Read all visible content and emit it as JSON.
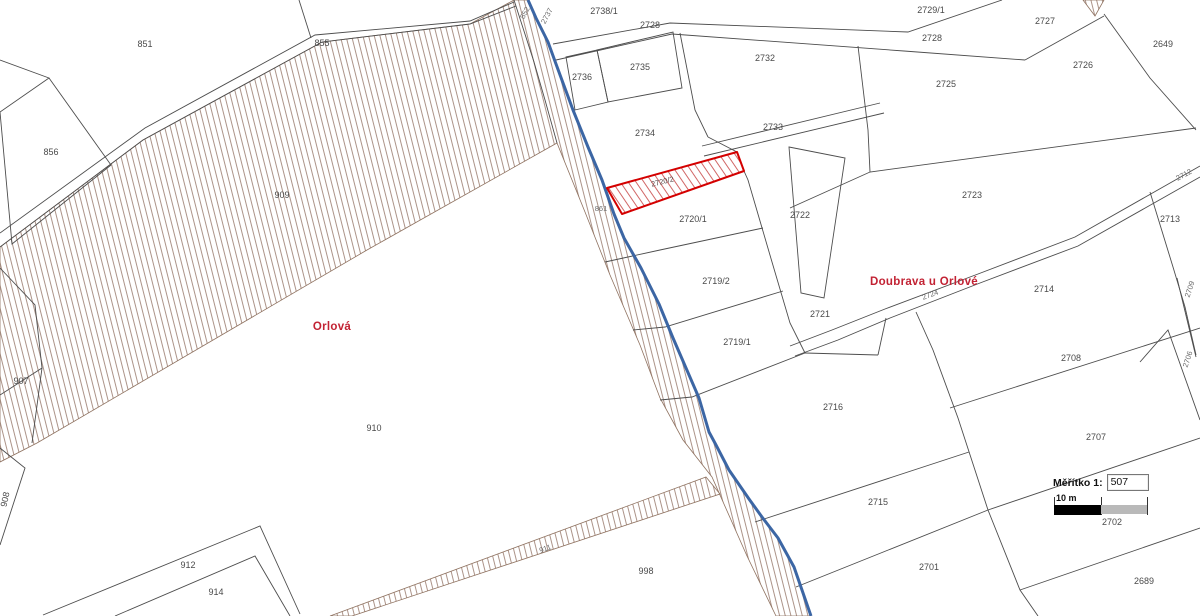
{
  "cities": {
    "left": "Orlová",
    "right": "Doubrava u Orlové"
  },
  "scale": {
    "label": "Měřítko 1:",
    "value": "507",
    "bar_label": "10 m"
  },
  "highlighted_parcel": "2720/2",
  "colors": {
    "boundary_blue": "#3c66a4",
    "parcel_line": "#4d4d4d",
    "hatch_brown": "#8f7260",
    "highlight_red": "#d40000",
    "city_text": "#c22233"
  },
  "parcels": [
    {
      "id": "851",
      "x": 145,
      "y": 47,
      "rot": 0
    },
    {
      "id": "855",
      "x": 322,
      "y": 46,
      "rot": 0
    },
    {
      "id": "856",
      "x": 51,
      "y": 155,
      "rot": 0
    },
    {
      "id": "909",
      "x": 282,
      "y": 198,
      "rot": 0
    },
    {
      "id": "907",
      "x": 21,
      "y": 384,
      "rot": 0
    },
    {
      "id": "908",
      "x": 8,
      "y": 500,
      "rot": -78
    },
    {
      "id": "910",
      "x": 374,
      "y": 431,
      "rot": 0
    },
    {
      "id": "912",
      "x": 188,
      "y": 568,
      "rot": 0
    },
    {
      "id": "914",
      "x": 216,
      "y": 595,
      "rot": 0
    },
    {
      "id": "911",
      "x": 546,
      "y": 551,
      "rot": -20,
      "small": true
    },
    {
      "id": "861",
      "x": 601,
      "y": 211,
      "rot": 0,
      "small": true
    },
    {
      "id": "852",
      "x": 527,
      "y": 14,
      "rot": -62,
      "small": true
    },
    {
      "id": "2737",
      "x": 549,
      "y": 17,
      "rot": -62,
      "small": true
    },
    {
      "id": "2738/1",
      "x": 604,
      "y": 14,
      "rot": 0
    },
    {
      "id": "2728",
      "x": 650,
      "y": 28,
      "rot": 0
    },
    {
      "id": "2736",
      "x": 582,
      "y": 80,
      "rot": 0
    },
    {
      "id": "2735",
      "x": 640,
      "y": 70,
      "rot": 0
    },
    {
      "id": "2734",
      "x": 645,
      "y": 136,
      "rot": 0
    },
    {
      "id": "2732",
      "x": 765,
      "y": 61,
      "rot": 0
    },
    {
      "id": "2733",
      "x": 773,
      "y": 130,
      "rot": 0
    },
    {
      "id": "2729/1",
      "x": 931,
      "y": 13,
      "rot": 0
    },
    {
      "id": "2728",
      "x": 932,
      "y": 41,
      "rot": 0
    },
    {
      "id": "2727",
      "x": 1045,
      "y": 24,
      "rot": 0
    },
    {
      "id": "2725",
      "x": 946,
      "y": 87,
      "rot": 0
    },
    {
      "id": "2726",
      "x": 1083,
      "y": 68,
      "rot": 0
    },
    {
      "id": "2649",
      "x": 1163,
      "y": 47,
      "rot": 0
    },
    {
      "id": "2723",
      "x": 972,
      "y": 198,
      "rot": 0
    },
    {
      "id": "2713",
      "x": 1170,
      "y": 222,
      "rot": 0
    },
    {
      "id": "2712",
      "x": 1185,
      "y": 177,
      "rot": -28,
      "small": true
    },
    {
      "id": "2722",
      "x": 800,
      "y": 218,
      "rot": 0
    },
    {
      "id": "2720/2",
      "x": 663,
      "y": 184,
      "rot": -14,
      "highlight": true
    },
    {
      "id": "2720/1",
      "x": 693,
      "y": 222,
      "rot": 0
    },
    {
      "id": "2719/2",
      "x": 716,
      "y": 284,
      "rot": 0
    },
    {
      "id": "2719/1",
      "x": 737,
      "y": 345,
      "rot": 0
    },
    {
      "id": "2721",
      "x": 820,
      "y": 317,
      "rot": 0
    },
    {
      "id": "2714",
      "x": 1044,
      "y": 292,
      "rot": 0
    },
    {
      "id": "2724",
      "x": 931,
      "y": 297,
      "rot": -20,
      "small": true
    },
    {
      "id": "2709",
      "x": 1192,
      "y": 290,
      "rot": -72,
      "small": true
    },
    {
      "id": "2706",
      "x": 1190,
      "y": 360,
      "rot": -72,
      "small": true
    },
    {
      "id": "2716",
      "x": 833,
      "y": 410,
      "rot": 0
    },
    {
      "id": "2715",
      "x": 878,
      "y": 505,
      "rot": 0
    },
    {
      "id": "2708",
      "x": 1071,
      "y": 361,
      "rot": 0
    },
    {
      "id": "2707",
      "x": 1096,
      "y": 440,
      "rot": 0
    },
    {
      "id": "2702",
      "x": 1112,
      "y": 525,
      "rot": 0
    },
    {
      "id": "2701",
      "x": 929,
      "y": 570,
      "rot": 0
    },
    {
      "id": "2689",
      "x": 1144,
      "y": 584,
      "rot": 0
    },
    {
      "id": "998",
      "x": 646,
      "y": 574,
      "rot": 0
    }
  ]
}
